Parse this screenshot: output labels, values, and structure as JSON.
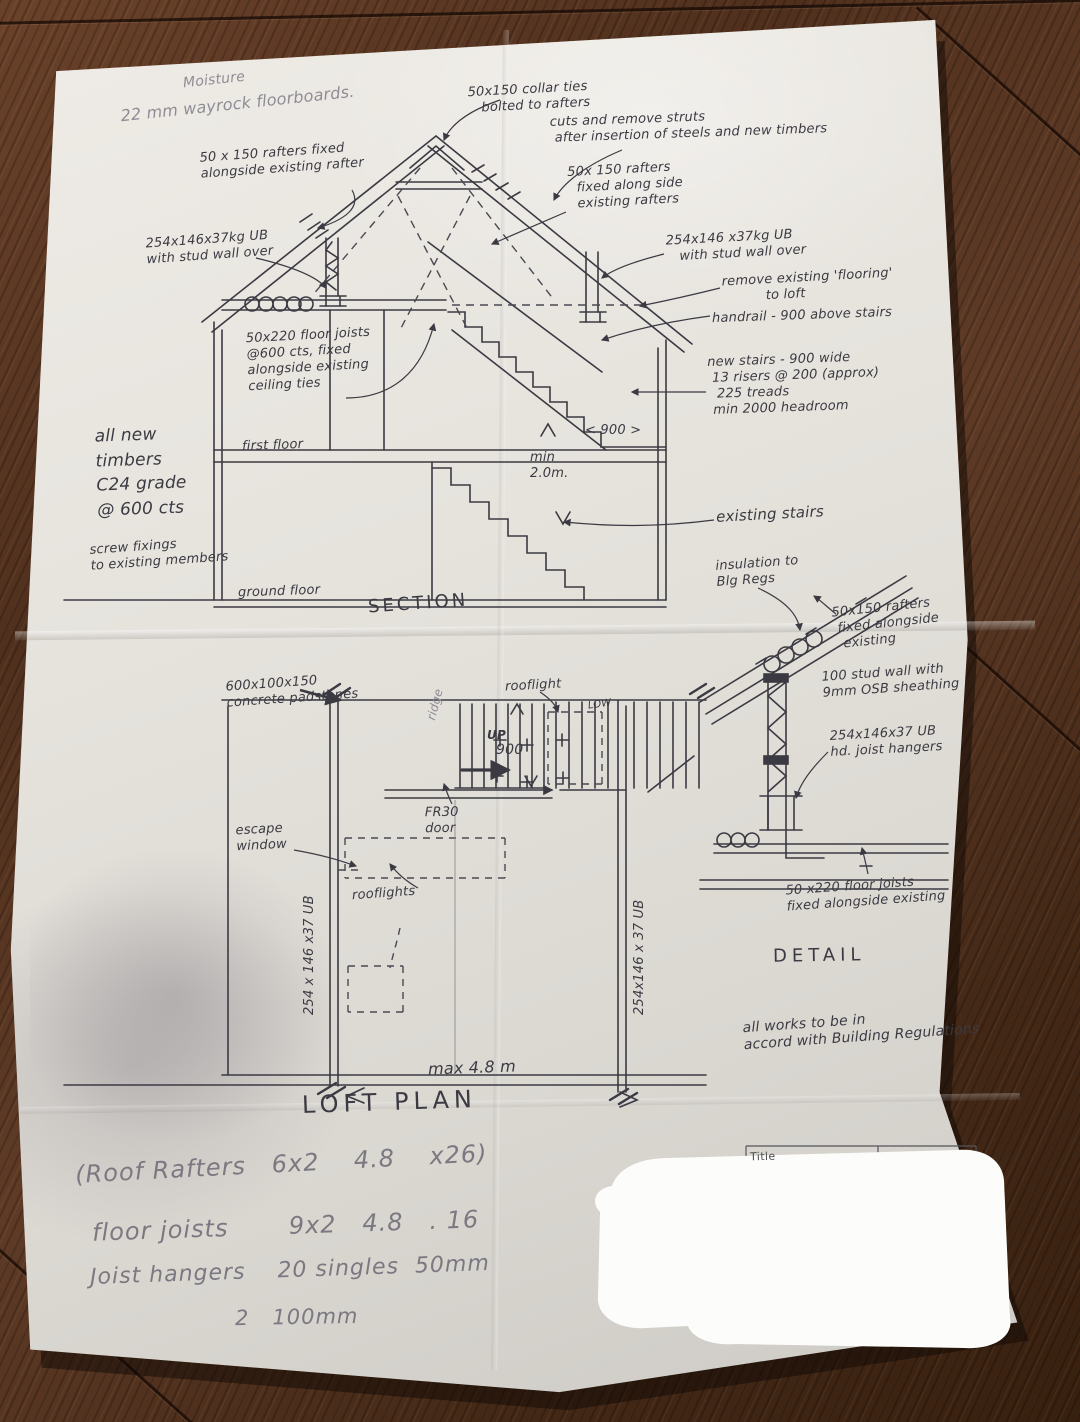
{
  "notes_top": {
    "moisture": "Moisture",
    "floorboards": "22 mm wayrock floorboards."
  },
  "section": {
    "title": "SECTION",
    "rafters_left": "50 x 150 rafters fixed\nalongside existing rafter",
    "collar_ties": "50x150 collar ties\n   bolted to rafters",
    "struts": "cuts and remove struts\n after insertion of steels and new timbers",
    "rafters_right": "50x 150 rafters\n  fixed along side\n  existing rafters",
    "ub_left": "254x146x37kg UB\nwith stud wall over",
    "ub_right": "254x146 x37kg UB\n   with stud wall over",
    "remove_flooring": "remove existing 'flooring'\n          to loft",
    "handrail": "handrail - 900 above stairs",
    "new_stairs": "new stairs - 900 wide\n 13 risers @ 200 (approx)\n  225 treads\n min 2000 headroom",
    "floor_joists": "50x220 floor joists\n@600 cts, fixed\nalongside existing\nceiling ties",
    "all_new_timbers": "all new\ntimbers\nC24 grade\n@ 600 cts",
    "screw_fixings": "screw fixings\nto existing members",
    "first_floor": "first floor",
    "ground_floor": "ground floor",
    "min_headroom": "min\n2.0m.",
    "dim_900": "< 900 >",
    "existing_stairs": "existing stairs"
  },
  "detail": {
    "title": "DETAIL",
    "insulation": "insulation to\nBlg Regs",
    "rafters": "50x150 rafters\n fixed alongside\n  existing",
    "stud_wall": "100 stud wall with\n9mm OSB sheathing",
    "ub_hangers": "254x146x37 UB\nhd. joist hangers",
    "floor_joists": "50 x220 floor joists\nfixed alongside existing",
    "works_note": "all works to be in\naccord with Building Regulations"
  },
  "loft_plan": {
    "title": "LOFT PLAN",
    "padstones": "600x100x150\nconcrete padstones",
    "ridge": "ridge",
    "rooflight": "rooflight",
    "dim_900": "900",
    "up": "UP",
    "low": "LOW",
    "fr30_door": "FR30\ndoor",
    "escape_window": "escape\nwindow",
    "rooflights": "rooflights",
    "ub_left": "254 x 146 x37 UB",
    "ub_right": "254x146 x 37 UB",
    "dim_max": "max 4.8 m"
  },
  "materials_list": {
    "line1": "(Roof Rafters   6x2    4.8    x26)",
    "line2": "floor joists       9x2   4.8   . 16",
    "line3": "Joist hangers    20 singles  50mm",
    "line4": "2   100mm"
  },
  "title_block": {
    "title_label": "Title"
  }
}
